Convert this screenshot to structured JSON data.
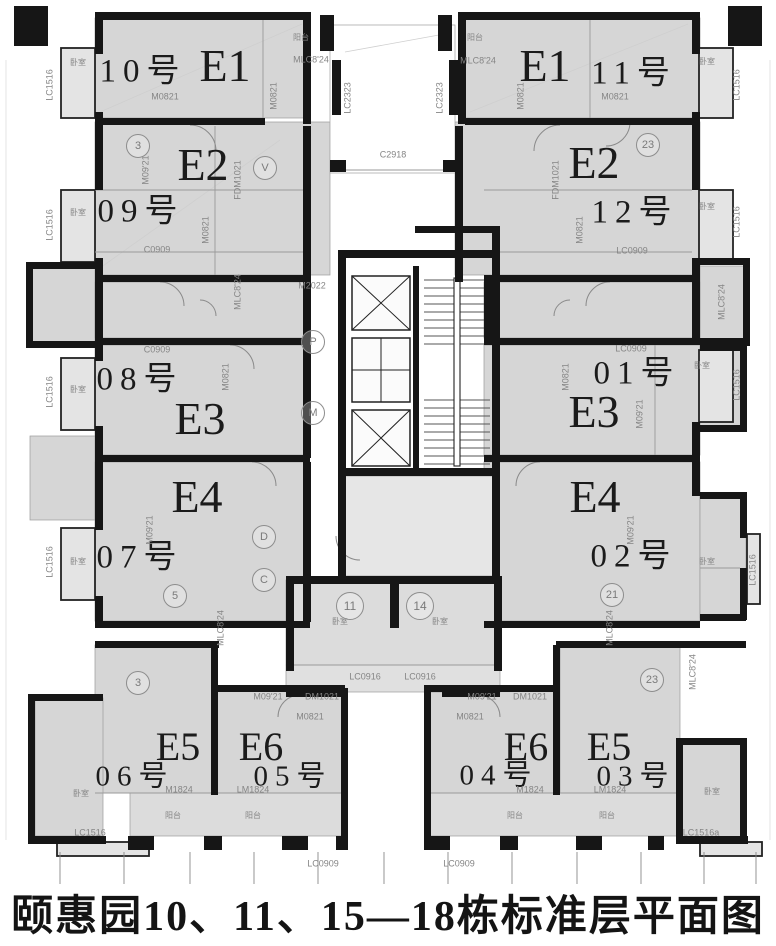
{
  "caption": "颐惠园10、11、15—18栋标准层平面图",
  "units": [
    {
      "unit": "E1",
      "number": "10号"
    },
    {
      "unit": "E1",
      "number": "11号"
    },
    {
      "unit": "E2",
      "number": "09号"
    },
    {
      "unit": "E2",
      "number": "12号"
    },
    {
      "unit": "E3",
      "number": "08号"
    },
    {
      "unit": "E3",
      "number": "01号"
    },
    {
      "unit": "E4",
      "number": "07号"
    },
    {
      "unit": "E4",
      "number": "02号"
    },
    {
      "unit": "E5",
      "number": "06号"
    },
    {
      "unit": "E5",
      "number": "03号"
    },
    {
      "unit": "E6",
      "number": "05号"
    },
    {
      "unit": "E6",
      "number": "04号"
    }
  ],
  "colors": {
    "wall": "#161616",
    "room_fill": "#d6d6d6",
    "bay_fill": "#e4e4e4",
    "line": "#9a9a9a",
    "annotation": "#858585",
    "text": "#1b1b1b"
  },
  "labels": [
    {
      "n": "unit-type-E1-left",
      "t": "E1",
      "x": 225,
      "y": 66,
      "k": "big"
    },
    {
      "n": "unit-type-E1-right",
      "t": "E1",
      "x": 545,
      "y": 66,
      "k": "big"
    },
    {
      "n": "unit-type-E2-left",
      "t": "E2",
      "x": 203,
      "y": 165,
      "k": "big"
    },
    {
      "n": "unit-type-E2-right",
      "t": "E2",
      "x": 594,
      "y": 163,
      "k": "big"
    },
    {
      "n": "unit-type-E3-left",
      "t": "E3",
      "x": 200,
      "y": 419,
      "k": "big"
    },
    {
      "n": "unit-type-E3-right",
      "t": "E3",
      "x": 594,
      "y": 412,
      "k": "big"
    },
    {
      "n": "unit-type-E4-left",
      "t": "E4",
      "x": 197,
      "y": 497,
      "k": "big"
    },
    {
      "n": "unit-type-E4-right",
      "t": "E4",
      "x": 595,
      "y": 497,
      "k": "big"
    },
    {
      "n": "unit-type-E5-left",
      "t": "E5",
      "x": 178,
      "y": 747,
      "k": "big",
      "s": 40
    },
    {
      "n": "unit-type-E6-left",
      "t": "E6",
      "x": 261,
      "y": 747,
      "k": "big",
      "s": 40
    },
    {
      "n": "unit-type-E6-right",
      "t": "E6",
      "x": 526,
      "y": 747,
      "k": "big",
      "s": 40
    },
    {
      "n": "unit-type-E5-right",
      "t": "E5",
      "x": 609,
      "y": 747,
      "k": "big",
      "s": 40
    },
    {
      "n": "apartment-number",
      "t": "10号",
      "x": 143,
      "y": 72,
      "k": "num"
    },
    {
      "n": "apartment-number",
      "t": "09号",
      "x": 141,
      "y": 212,
      "k": "num"
    },
    {
      "n": "apartment-number",
      "t": "08号",
      "x": 140,
      "y": 380,
      "k": "num"
    },
    {
      "n": "apartment-number",
      "t": "07号",
      "x": 140,
      "y": 558,
      "k": "num"
    },
    {
      "n": "apartment-number",
      "t": "06号",
      "x": 135,
      "y": 777,
      "k": "num",
      "s": 29
    },
    {
      "n": "apartment-number",
      "t": "05号",
      "x": 293,
      "y": 777,
      "k": "num",
      "s": 29
    },
    {
      "n": "apartment-number",
      "t": "11号",
      "x": 634,
      "y": 74,
      "k": "num"
    },
    {
      "n": "apartment-number",
      "t": "12号",
      "x": 635,
      "y": 213,
      "k": "num"
    },
    {
      "n": "apartment-number",
      "t": "01号",
      "x": 637,
      "y": 374,
      "k": "num"
    },
    {
      "n": "apartment-number",
      "t": "02号",
      "x": 634,
      "y": 557,
      "k": "num"
    },
    {
      "n": "apartment-number",
      "t": "04号",
      "x": 499,
      "y": 776,
      "k": "num",
      "s": 29
    },
    {
      "n": "apartment-number",
      "t": "03号",
      "x": 636,
      "y": 777,
      "k": "num",
      "s": 29
    },
    {
      "n": "window-code",
      "t": "LC1516",
      "x": 50,
      "y": 85,
      "k": "ann",
      "r": -90
    },
    {
      "n": "window-code",
      "t": "LC1516",
      "x": 50,
      "y": 225,
      "k": "ann",
      "r": -90
    },
    {
      "n": "window-code",
      "t": "LC1516",
      "x": 50,
      "y": 392,
      "k": "ann",
      "r": -90
    },
    {
      "n": "window-code",
      "t": "LC1516",
      "x": 50,
      "y": 562,
      "k": "ann",
      "r": -90
    },
    {
      "n": "window-code",
      "t": "LC1516",
      "x": 737,
      "y": 85,
      "k": "ann",
      "r": -90
    },
    {
      "n": "window-code",
      "t": "LC1516",
      "x": 737,
      "y": 222,
      "k": "ann",
      "r": -90
    },
    {
      "n": "window-code",
      "t": "LC1516",
      "x": 737,
      "y": 385,
      "k": "ann",
      "r": -90
    },
    {
      "n": "window-code",
      "t": "LC1516",
      "x": 753,
      "y": 570,
      "k": "ann",
      "r": -90
    },
    {
      "n": "window-code",
      "t": "LC1516",
      "x": 90,
      "y": 833,
      "k": "ann"
    },
    {
      "n": "window-code",
      "t": "LC1516a",
      "x": 701,
      "y": 833,
      "k": "ann"
    },
    {
      "n": "door-code",
      "t": "MLC8'24",
      "x": 311,
      "y": 60,
      "k": "ann"
    },
    {
      "n": "door-code",
      "t": "MLC8'24",
      "x": 478,
      "y": 61,
      "k": "ann"
    },
    {
      "n": "door-code",
      "t": "MLC8'24",
      "x": 238,
      "y": 292,
      "k": "ann",
      "r": -90
    },
    {
      "n": "door-code",
      "t": "MLC8'24",
      "x": 722,
      "y": 302,
      "k": "ann",
      "r": -90
    },
    {
      "n": "door-code",
      "t": "MLC8'24",
      "x": 221,
      "y": 628,
      "k": "ann",
      "r": -90
    },
    {
      "n": "door-code",
      "t": "MLC8'24",
      "x": 610,
      "y": 628,
      "k": "ann",
      "r": -90
    },
    {
      "n": "door-code",
      "t": "MLC8'24",
      "x": 693,
      "y": 672,
      "k": "ann",
      "r": -90
    },
    {
      "n": "door-code",
      "t": "M0821",
      "x": 165,
      "y": 97,
      "k": "ann"
    },
    {
      "n": "door-code",
      "t": "M0821",
      "x": 274,
      "y": 96,
      "k": "ann",
      "r": -90
    },
    {
      "n": "door-code",
      "t": "M0821",
      "x": 521,
      "y": 96,
      "k": "ann",
      "r": -90
    },
    {
      "n": "door-code",
      "t": "M0821",
      "x": 615,
      "y": 97,
      "k": "ann"
    },
    {
      "n": "door-code",
      "t": "M0821",
      "x": 206,
      "y": 230,
      "k": "ann",
      "r": -90
    },
    {
      "n": "door-code",
      "t": "M0821",
      "x": 580,
      "y": 230,
      "k": "ann",
      "r": -90
    },
    {
      "n": "door-code",
      "t": "M0821",
      "x": 226,
      "y": 377,
      "k": "ann",
      "r": -90
    },
    {
      "n": "door-code",
      "t": "M0821",
      "x": 566,
      "y": 377,
      "k": "ann",
      "r": -90
    },
    {
      "n": "door-code",
      "t": "M0821",
      "x": 310,
      "y": 717,
      "k": "ann"
    },
    {
      "n": "door-code",
      "t": "M0821",
      "x": 470,
      "y": 717,
      "k": "ann"
    },
    {
      "n": "door-code",
      "t": "M09'21",
      "x": 146,
      "y": 170,
      "k": "ann",
      "r": -90
    },
    {
      "n": "door-code",
      "t": "M09'21",
      "x": 640,
      "y": 414,
      "k": "ann",
      "r": -90
    },
    {
      "n": "door-code",
      "t": "M09'21",
      "x": 150,
      "y": 530,
      "k": "ann",
      "r": -90
    },
    {
      "n": "door-code",
      "t": "M09'21",
      "x": 631,
      "y": 530,
      "k": "ann",
      "r": -90
    },
    {
      "n": "door-code",
      "t": "M09'21",
      "x": 268,
      "y": 697,
      "k": "ann"
    },
    {
      "n": "door-code",
      "t": "M09'21",
      "x": 482,
      "y": 697,
      "k": "ann"
    },
    {
      "n": "door-code",
      "t": "DM1021",
      "x": 322,
      "y": 697,
      "k": "ann"
    },
    {
      "n": "door-code",
      "t": "DM1021",
      "x": 530,
      "y": 697,
      "k": "ann"
    },
    {
      "n": "door-code",
      "t": "FDM1021",
      "x": 238,
      "y": 180,
      "k": "ann",
      "r": -90
    },
    {
      "n": "door-code",
      "t": "FDM1021",
      "x": 556,
      "y": 180,
      "k": "ann",
      "r": -90
    },
    {
      "n": "window-code",
      "t": "LC0909",
      "x": 632,
      "y": 251,
      "k": "ann"
    },
    {
      "n": "window-code",
      "t": "LC0909",
      "x": 631,
      "y": 349,
      "k": "ann"
    },
    {
      "n": "window-code",
      "t": "LC0909",
      "x": 323,
      "y": 864,
      "k": "ann"
    },
    {
      "n": "window-code",
      "t": "LC0909",
      "x": 459,
      "y": 864,
      "k": "ann"
    },
    {
      "n": "window-code",
      "t": "C0909",
      "x": 157,
      "y": 250,
      "k": "ann"
    },
    {
      "n": "window-code",
      "t": "C0909",
      "x": 157,
      "y": 350,
      "k": "ann"
    },
    {
      "n": "window-code",
      "t": "LC0916",
      "x": 365,
      "y": 677,
      "k": "ann"
    },
    {
      "n": "window-code",
      "t": "LC0916",
      "x": 420,
      "y": 677,
      "k": "ann"
    },
    {
      "n": "door-code",
      "t": "LM1824",
      "x": 253,
      "y": 790,
      "k": "ann"
    },
    {
      "n": "door-code",
      "t": "LM1824",
      "x": 610,
      "y": 790,
      "k": "ann"
    },
    {
      "n": "door-code",
      "t": "M1824",
      "x": 179,
      "y": 790,
      "k": "ann"
    },
    {
      "n": "door-code",
      "t": "M1824",
      "x": 530,
      "y": 790,
      "k": "ann"
    },
    {
      "n": "window-code",
      "t": "LC2323",
      "x": 348,
      "y": 98,
      "k": "ann",
      "r": -90
    },
    {
      "n": "window-code",
      "t": "LC2323",
      "x": 440,
      "y": 98,
      "k": "ann",
      "r": -90
    },
    {
      "n": "window-code",
      "t": "M2022",
      "x": 312,
      "y": 286,
      "k": "ann"
    },
    {
      "n": "window-code",
      "t": "C2918",
      "x": 393,
      "y": 155,
      "k": "ann"
    },
    {
      "n": "room-tag",
      "t": "卧室",
      "x": 78,
      "y": 63,
      "k": "ann",
      "s": 8
    },
    {
      "n": "room-tag",
      "t": "卧室",
      "x": 78,
      "y": 213,
      "k": "ann",
      "s": 8
    },
    {
      "n": "room-tag",
      "t": "卧室",
      "x": 78,
      "y": 390,
      "k": "ann",
      "s": 8
    },
    {
      "n": "room-tag",
      "t": "卧室",
      "x": 78,
      "y": 562,
      "k": "ann",
      "s": 8
    },
    {
      "n": "room-tag",
      "t": "卧室",
      "x": 707,
      "y": 62,
      "k": "ann",
      "s": 8
    },
    {
      "n": "room-tag",
      "t": "卧室",
      "x": 707,
      "y": 207,
      "k": "ann",
      "s": 8
    },
    {
      "n": "room-tag",
      "t": "卧室",
      "x": 702,
      "y": 366,
      "k": "ann",
      "s": 8
    },
    {
      "n": "room-tag",
      "t": "卧室",
      "x": 707,
      "y": 562,
      "k": "ann",
      "s": 8
    },
    {
      "n": "room-tag",
      "t": "卧室",
      "x": 81,
      "y": 794,
      "k": "ann",
      "s": 8
    },
    {
      "n": "room-tag",
      "t": "卧室",
      "x": 712,
      "y": 792,
      "k": "ann",
      "s": 8
    },
    {
      "n": "room-tag",
      "t": "卧室",
      "x": 340,
      "y": 622,
      "k": "ann",
      "s": 8
    },
    {
      "n": "room-tag",
      "t": "卧室",
      "x": 440,
      "y": 622,
      "k": "ann",
      "s": 8
    },
    {
      "n": "room-tag",
      "t": "阳台",
      "x": 301,
      "y": 38,
      "k": "ann",
      "s": 8
    },
    {
      "n": "room-tag",
      "t": "阳台",
      "x": 475,
      "y": 38,
      "k": "ann",
      "s": 8
    },
    {
      "n": "room-tag",
      "t": "阳台",
      "x": 173,
      "y": 816,
      "k": "ann",
      "s": 8
    },
    {
      "n": "room-tag",
      "t": "阳台",
      "x": 253,
      "y": 816,
      "k": "ann",
      "s": 8
    },
    {
      "n": "room-tag",
      "t": "阳台",
      "x": 515,
      "y": 816,
      "k": "ann",
      "s": 8
    },
    {
      "n": "room-tag",
      "t": "阳台",
      "x": 607,
      "y": 816,
      "k": "ann",
      "s": 8
    },
    {
      "n": "grid-bubble",
      "t": "3",
      "x": 138,
      "y": 146,
      "k": "circ"
    },
    {
      "n": "grid-bubble",
      "t": "3",
      "x": 138,
      "y": 683,
      "k": "circ"
    },
    {
      "n": "grid-bubble",
      "t": "5",
      "x": 175,
      "y": 596,
      "k": "circ"
    },
    {
      "n": "grid-bubble",
      "t": "11",
      "x": 350,
      "y": 606,
      "k": "circ",
      "d": 26,
      "s": 12
    },
    {
      "n": "grid-bubble",
      "t": "14",
      "x": 420,
      "y": 606,
      "k": "circ",
      "d": 26,
      "s": 12
    },
    {
      "n": "grid-bubble",
      "t": "21",
      "x": 612,
      "y": 595,
      "k": "circ"
    },
    {
      "n": "grid-bubble",
      "t": "23",
      "x": 648,
      "y": 145,
      "k": "circ"
    },
    {
      "n": "grid-bubble",
      "t": "23",
      "x": 652,
      "y": 680,
      "k": "circ"
    },
    {
      "n": "shaft-bubble",
      "t": "V",
      "x": 265,
      "y": 168,
      "k": "circ"
    },
    {
      "n": "shaft-bubble",
      "t": "P",
      "x": 313,
      "y": 342,
      "k": "circ"
    },
    {
      "n": "shaft-bubble",
      "t": "M",
      "x": 313,
      "y": 413,
      "k": "circ"
    },
    {
      "n": "shaft-bubble",
      "t": "D",
      "x": 264,
      "y": 537,
      "k": "circ"
    },
    {
      "n": "shaft-bubble",
      "t": "C",
      "x": 264,
      "y": 580,
      "k": "circ"
    }
  ]
}
